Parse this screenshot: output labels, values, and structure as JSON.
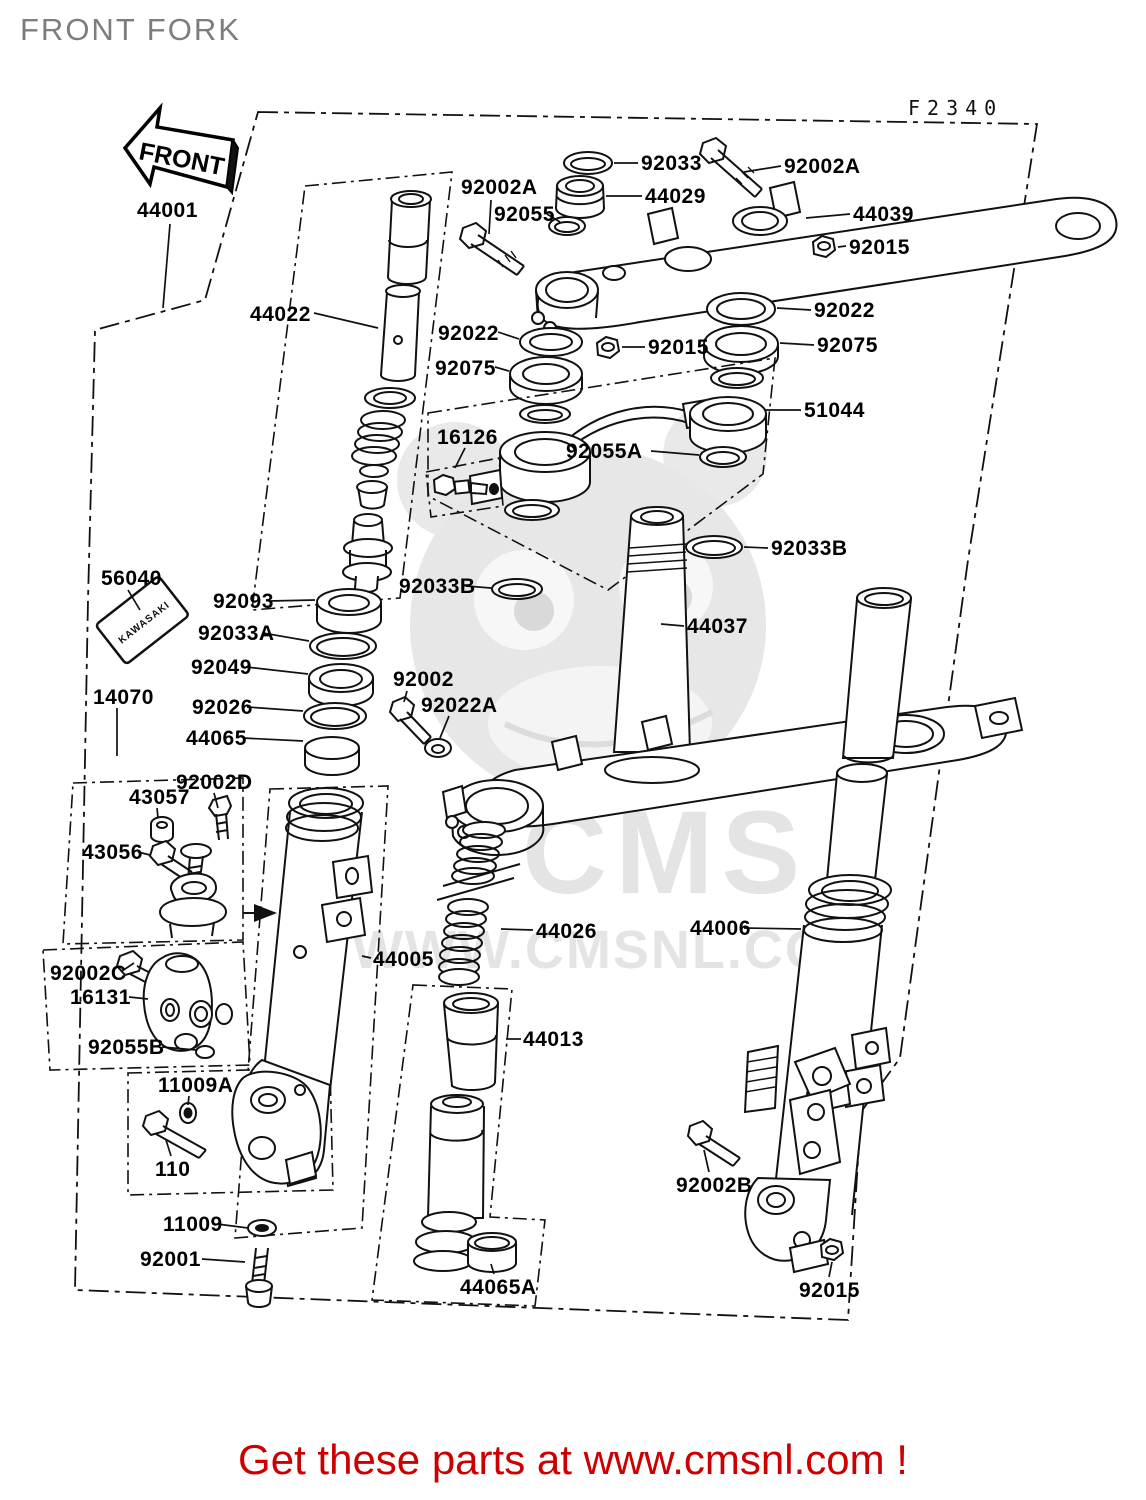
{
  "page": {
    "title": "FRONT FORK",
    "figure_code": "F2340",
    "front_arrow_text": "FRONT",
    "footer_text": "Get these parts at www.cmsnl.com !",
    "colors": {
      "footer": "#cc0000",
      "title": "#7d7d7d",
      "watermark": "#e4e4e4",
      "line": "#111111"
    }
  },
  "watermark": {
    "brand": "CMS",
    "url": "WWW.CMSNL.COM"
  },
  "sticker_text": "KAWASAKI",
  "parts": {
    "p44001": "44001",
    "p92033": "92033",
    "p92002a_top": "92002A",
    "p92002a_left": "92002A",
    "p92055": "92055",
    "p44029": "44029",
    "p44039": "44039",
    "p92015_top": "92015",
    "p92022_right": "92022",
    "p92075_right": "92075",
    "p44022": "44022",
    "p92022_left": "92022",
    "p92075_left": "92075",
    "p92015_mid": "92015",
    "p51044": "51044",
    "p16126": "16126",
    "p92055a": "92055A",
    "p92033b_right": "92033B",
    "p92033b_left": "92033B",
    "p56040": "56040",
    "p92093": "92093",
    "p92033a": "92033A",
    "p92049": "92049",
    "p44037": "44037",
    "p92026": "92026",
    "p44065": "44065",
    "p92002": "92002",
    "p92022a": "92022A",
    "p14070": "14070",
    "p92002d": "92002D",
    "p43057": "43057",
    "p43056": "43056",
    "p92002c": "92002C",
    "p16131": "16131",
    "p92055b": "92055B",
    "p11009a": "11009A",
    "p110": "110",
    "p44005": "44005",
    "p44026": "44026",
    "p44006": "44006",
    "p44013": "44013",
    "p11009": "11009",
    "p92001": "92001",
    "p44065a": "44065A",
    "p92002b": "92002B",
    "p92015_bottom": "92015"
  }
}
